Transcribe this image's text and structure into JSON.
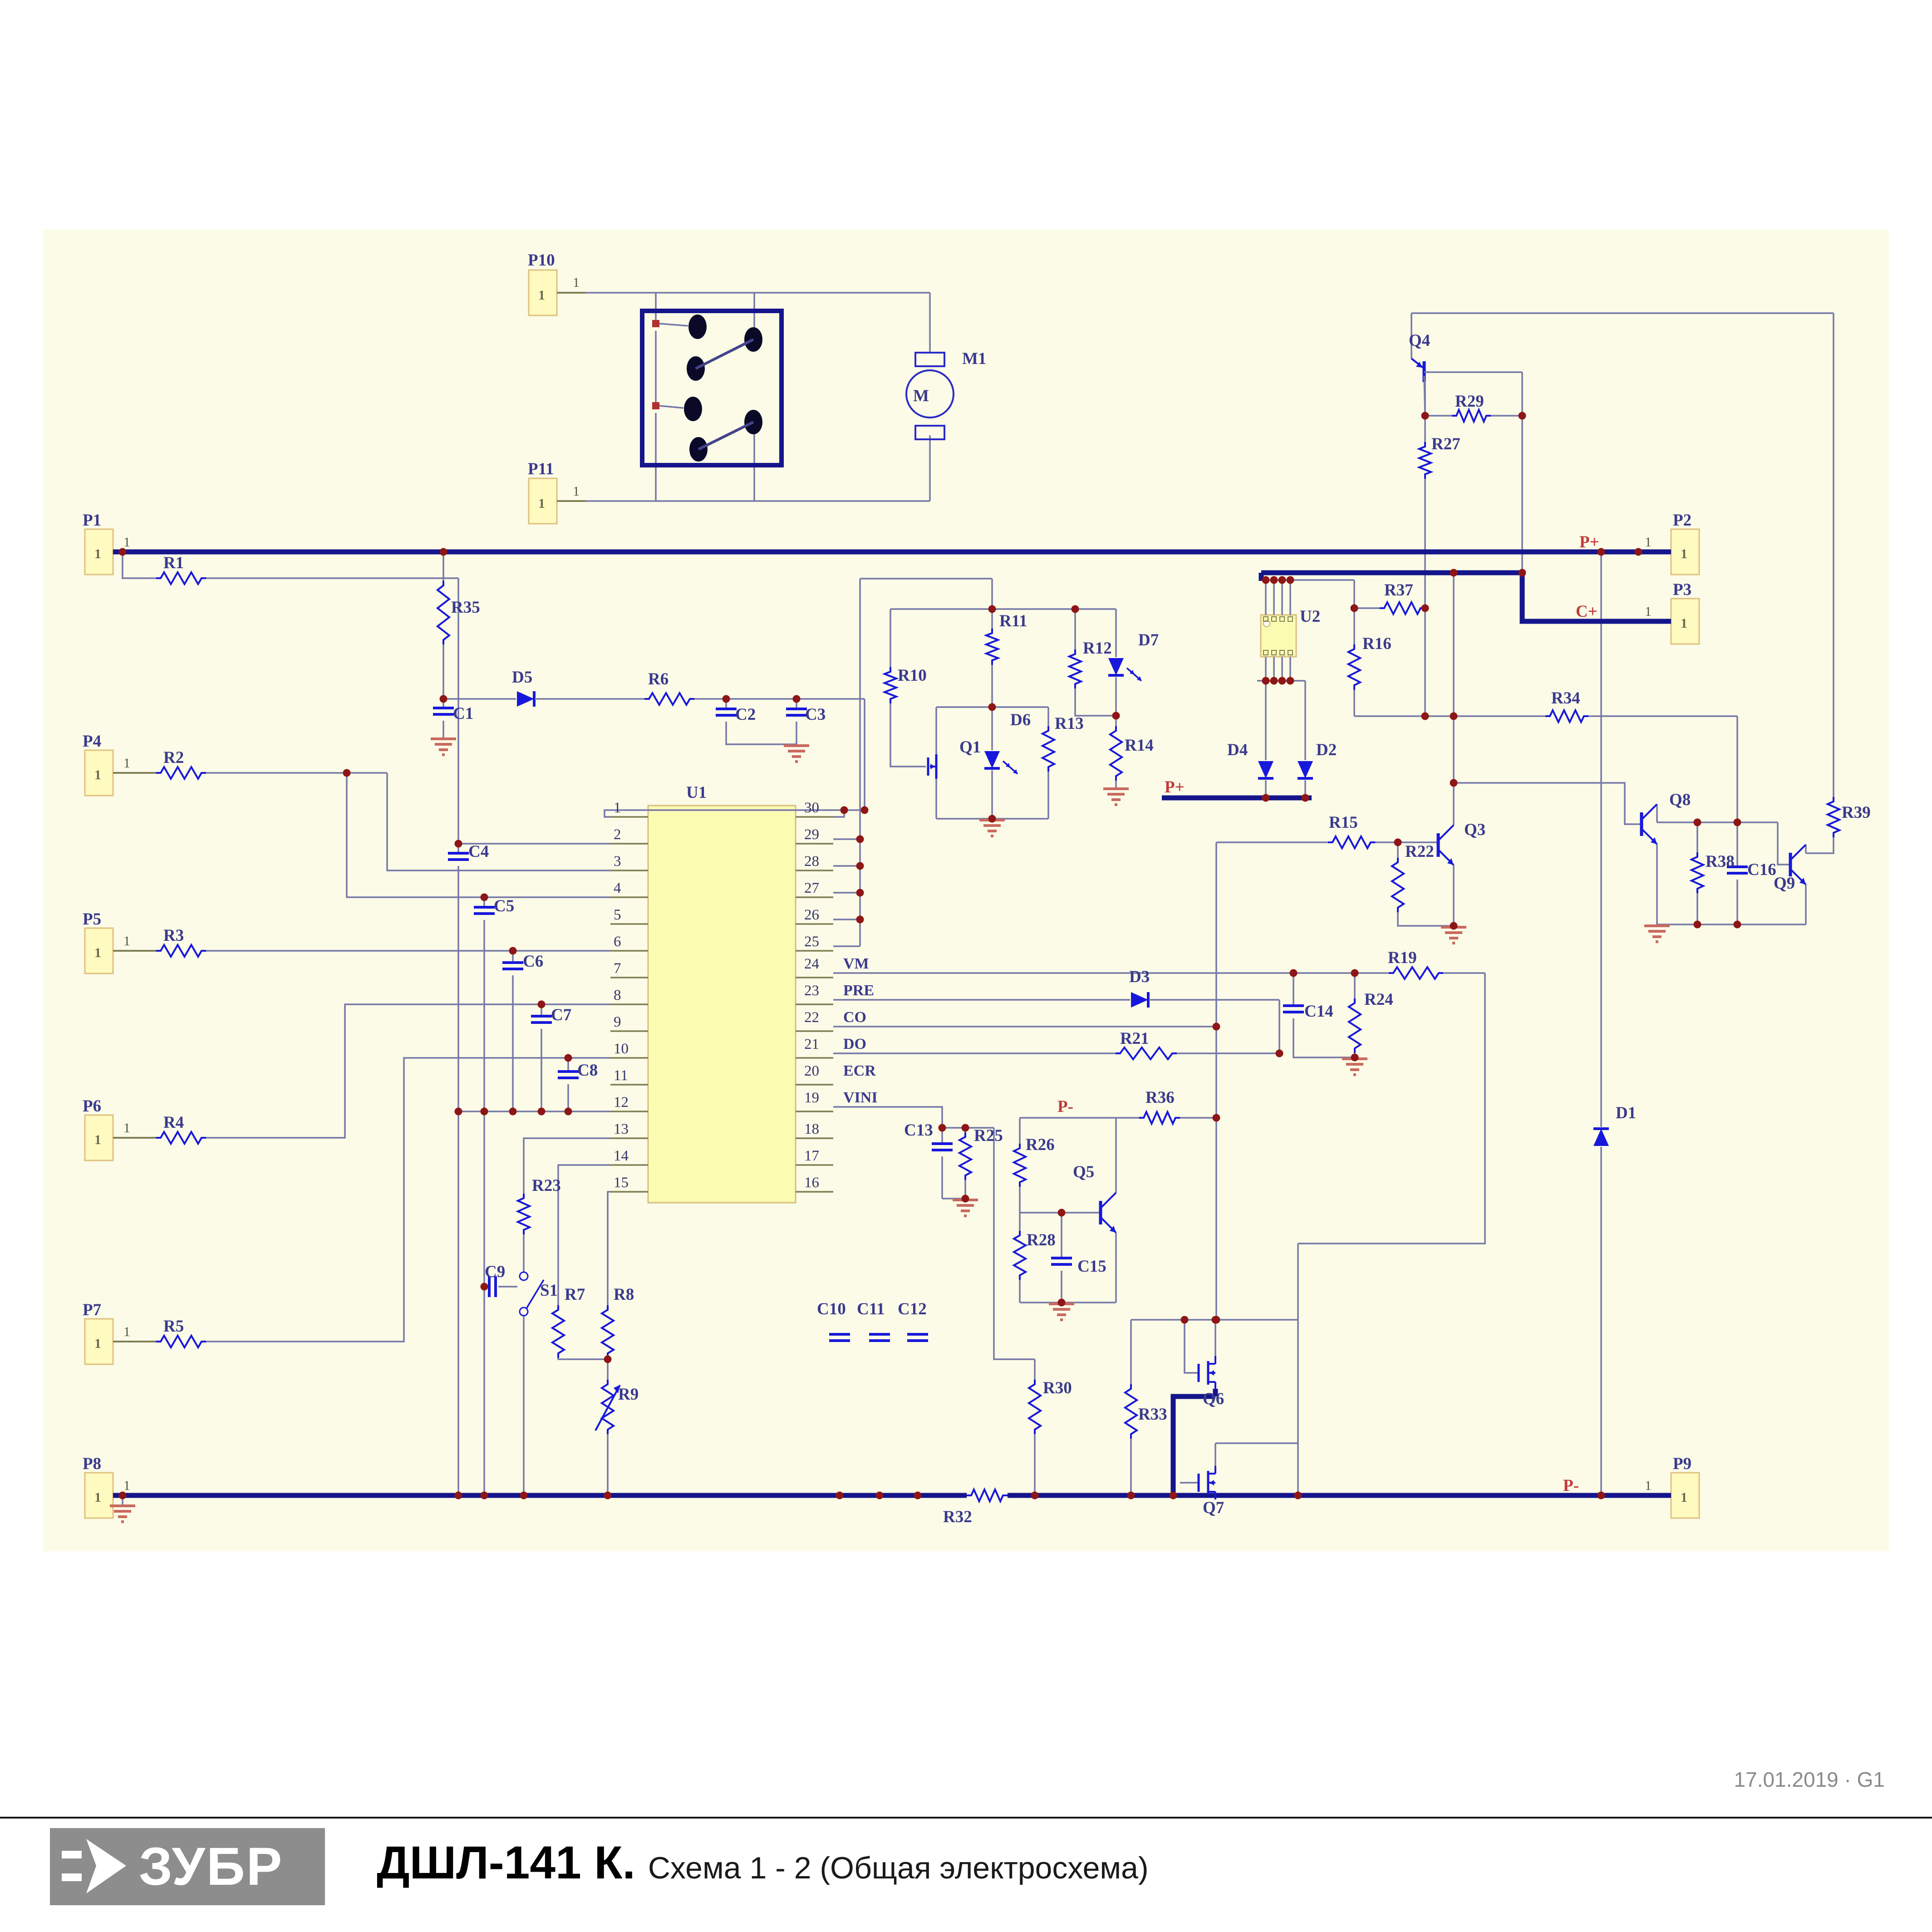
{
  "meta": {
    "date_note": "17.01.2019 · G1"
  },
  "footer": {
    "brand": "ЗУБР",
    "model": "ДШЛ-141 К.",
    "subtitle": "Схема 1 - 2 (Общая электросхема)"
  },
  "schematic": {
    "u1_pin_names": [
      "VM",
      "PRE",
      "CO",
      "DO",
      "ECR",
      "VINI"
    ],
    "labels": [
      [
        "P10",
        1163,
        585,
        "r"
      ],
      [
        "P11",
        1163,
        1045,
        "r"
      ],
      [
        "P1",
        182,
        1158,
        "r"
      ],
      [
        "P2",
        3686,
        1158,
        "r"
      ],
      [
        "P3",
        3686,
        1311,
        "r"
      ],
      [
        "P4",
        182,
        1645,
        "r"
      ],
      [
        "P5",
        182,
        2037,
        "r"
      ],
      [
        "P6",
        182,
        2449,
        "r"
      ],
      [
        "P7",
        182,
        2898,
        "r"
      ],
      [
        "P8",
        182,
        3237,
        "r"
      ],
      [
        "P9",
        3686,
        3237,
        "r"
      ],
      [
        "U1",
        1512,
        1758,
        "r"
      ],
      [
        "U2",
        2864,
        1370,
        "r"
      ],
      [
        "M1",
        2120,
        802,
        "r"
      ],
      [
        "M",
        2012,
        884,
        "r"
      ],
      [
        "S1",
        1190,
        2855,
        "r"
      ],
      [
        "R1",
        360,
        1252,
        "r"
      ],
      [
        "R2",
        360,
        1681,
        "r"
      ],
      [
        "R3",
        360,
        2073,
        "r"
      ],
      [
        "R4",
        360,
        2485,
        "r"
      ],
      [
        "R5",
        360,
        2934,
        "r"
      ],
      [
        "R6",
        1428,
        1508,
        "r"
      ],
      [
        "R7",
        1244,
        2864,
        "r"
      ],
      [
        "R8",
        1352,
        2864,
        "r"
      ],
      [
        "R9",
        1362,
        3084,
        "r"
      ],
      [
        "R10",
        1978,
        1500,
        "r"
      ],
      [
        "R11",
        2202,
        1380,
        "r"
      ],
      [
        "R12",
        2386,
        1440,
        "r"
      ],
      [
        "R13",
        2324,
        1606,
        "r"
      ],
      [
        "R14",
        2478,
        1654,
        "r"
      ],
      [
        "R15",
        2928,
        1824,
        "r"
      ],
      [
        "R16",
        3002,
        1430,
        "r"
      ],
      [
        "R19",
        3058,
        2122,
        "r"
      ],
      [
        "R21",
        2468,
        2300,
        "r"
      ],
      [
        "R22",
        3096,
        1888,
        "r"
      ],
      [
        "R23",
        1172,
        2624,
        "r"
      ],
      [
        "R24",
        3006,
        2214,
        "r"
      ],
      [
        "R25",
        2146,
        2514,
        "r"
      ],
      [
        "R26",
        2260,
        2534,
        "r"
      ],
      [
        "R27",
        3154,
        990,
        "r"
      ],
      [
        "R28",
        2262,
        2744,
        "r"
      ],
      [
        "R29",
        3206,
        896,
        "r"
      ],
      [
        "R30",
        2298,
        3070,
        "r"
      ],
      [
        "R32",
        2078,
        3354,
        "r"
      ],
      [
        "R33",
        2508,
        3128,
        "r"
      ],
      [
        "R34",
        3418,
        1550,
        "r"
      ],
      [
        "R35",
        994,
        1350,
        "r"
      ],
      [
        "R36",
        2524,
        2430,
        "r"
      ],
      [
        "R37",
        3050,
        1312,
        "r"
      ],
      [
        "R38",
        3758,
        1910,
        "r"
      ],
      [
        "R39",
        4058,
        1802,
        "r"
      ],
      [
        "C1",
        998,
        1584,
        "r"
      ],
      [
        "C2",
        1620,
        1586,
        "r"
      ],
      [
        "C3",
        1774,
        1586,
        "r"
      ],
      [
        "C4",
        1032,
        1888,
        "r"
      ],
      [
        "C5",
        1088,
        2008,
        "r"
      ],
      [
        "C6",
        1152,
        2130,
        "r"
      ],
      [
        "C7",
        1214,
        2248,
        "r"
      ],
      [
        "C8",
        1272,
        2370,
        "r"
      ],
      [
        "C9",
        1068,
        2814,
        "r"
      ],
      [
        "C10",
        1800,
        2896,
        "r"
      ],
      [
        "C11",
        1888,
        2896,
        "r"
      ],
      [
        "C12",
        1978,
        2896,
        "r"
      ],
      [
        "C13",
        1992,
        2502,
        "r"
      ],
      [
        "C14",
        2874,
        2240,
        "r"
      ],
      [
        "C15",
        2374,
        2802,
        "r"
      ],
      [
        "C16",
        3850,
        1928,
        "r"
      ],
      [
        "D1",
        3560,
        2464,
        "r"
      ],
      [
        "D2",
        2900,
        1664,
        "r"
      ],
      [
        "D3",
        2488,
        2164,
        "r"
      ],
      [
        "D4",
        2704,
        1664,
        "r"
      ],
      [
        "D5",
        1128,
        1504,
        "r"
      ],
      [
        "D6",
        2226,
        1598,
        "r"
      ],
      [
        "D7",
        2508,
        1422,
        "r"
      ],
      [
        "Q1",
        2114,
        1658,
        "r"
      ],
      [
        "Q3",
        3226,
        1840,
        "r"
      ],
      [
        "Q4",
        3104,
        762,
        "r"
      ],
      [
        "Q5",
        2364,
        2594,
        "r"
      ],
      [
        "Q6",
        2650,
        3094,
        "r"
      ],
      [
        "Q7",
        2650,
        3334,
        "r"
      ],
      [
        "Q8",
        3678,
        1774,
        "r"
      ],
      [
        "Q9",
        3908,
        1958,
        "r"
      ],
      [
        "1",
        1352,
        1790,
        "p"
      ],
      [
        "2",
        1352,
        1849,
        "p"
      ],
      [
        "3",
        1352,
        1908,
        "p"
      ],
      [
        "4",
        1352,
        1967,
        "p"
      ],
      [
        "5",
        1352,
        2026,
        "p"
      ],
      [
        "6",
        1352,
        2085,
        "p"
      ],
      [
        "7",
        1352,
        2144,
        "p"
      ],
      [
        "8",
        1352,
        2203,
        "p"
      ],
      [
        "9",
        1352,
        2262,
        "p"
      ],
      [
        "10",
        1352,
        2321,
        "p"
      ],
      [
        "11",
        1352,
        2380,
        "p"
      ],
      [
        "12",
        1352,
        2439,
        "p"
      ],
      [
        "13",
        1352,
        2498,
        "p"
      ],
      [
        "14",
        1352,
        2557,
        "p"
      ],
      [
        "15",
        1352,
        2616,
        "p"
      ],
      [
        "30",
        1772,
        1790,
        "p"
      ],
      [
        "29",
        1772,
        1849,
        "p"
      ],
      [
        "28",
        1772,
        1908,
        "p"
      ],
      [
        "27",
        1772,
        1967,
        "p"
      ],
      [
        "26",
        1772,
        2026,
        "p"
      ],
      [
        "25",
        1772,
        2085,
        "p"
      ],
      [
        "24",
        1772,
        2134,
        "p"
      ],
      [
        "23",
        1772,
        2193,
        "p"
      ],
      [
        "22",
        1772,
        2252,
        "p"
      ],
      [
        "21",
        1772,
        2311,
        "p"
      ],
      [
        "20",
        1772,
        2370,
        "p"
      ],
      [
        "19",
        1772,
        2429,
        "p"
      ],
      [
        "18",
        1772,
        2498,
        "p"
      ],
      [
        "17",
        1772,
        2557,
        "p"
      ],
      [
        "16",
        1772,
        2616,
        "p"
      ],
      [
        "VM",
        1858,
        2134,
        "m"
      ],
      [
        "PRE",
        1858,
        2193,
        "m"
      ],
      [
        "CO",
        1858,
        2252,
        "m"
      ],
      [
        "DO",
        1858,
        2311,
        "m"
      ],
      [
        "ECR",
        1858,
        2370,
        "m"
      ],
      [
        "VINI",
        1858,
        2429,
        "m"
      ],
      [
        "1",
        1262,
        632,
        "s"
      ],
      [
        "1",
        1262,
        1092,
        "s"
      ],
      [
        "1",
        272,
        1204,
        "s"
      ],
      [
        "1",
        272,
        1691,
        "s"
      ],
      [
        "1",
        272,
        2083,
        "s"
      ],
      [
        "1",
        272,
        2495,
        "s"
      ],
      [
        "1",
        272,
        2944,
        "s"
      ],
      [
        "1",
        272,
        3283,
        "s"
      ],
      [
        "1",
        3624,
        1204,
        "s"
      ],
      [
        "1",
        3624,
        1357,
        "s"
      ],
      [
        "1",
        3624,
        3283,
        "s"
      ],
      [
        "1",
        1186,
        660,
        "b"
      ],
      [
        "1",
        1186,
        1119,
        "b"
      ],
      [
        "1",
        208,
        1230,
        "b"
      ],
      [
        "1",
        208,
        1717,
        "b"
      ],
      [
        "1",
        208,
        2109,
        "b"
      ],
      [
        "1",
        208,
        2521,
        "b"
      ],
      [
        "1",
        208,
        2970,
        "b"
      ],
      [
        "1",
        208,
        3309,
        "b"
      ],
      [
        "1",
        3703,
        1230,
        "b"
      ],
      [
        "1",
        3703,
        1383,
        "b"
      ],
      [
        "1",
        3703,
        3309,
        "b"
      ],
      [
        "P+",
        3480,
        1206,
        "n"
      ],
      [
        "C+",
        3472,
        1359,
        "n"
      ],
      [
        "P+",
        2566,
        1746,
        "n"
      ],
      [
        "P-",
        2330,
        2450,
        "n"
      ],
      [
        "P-",
        3444,
        3285,
        "n"
      ]
    ]
  }
}
